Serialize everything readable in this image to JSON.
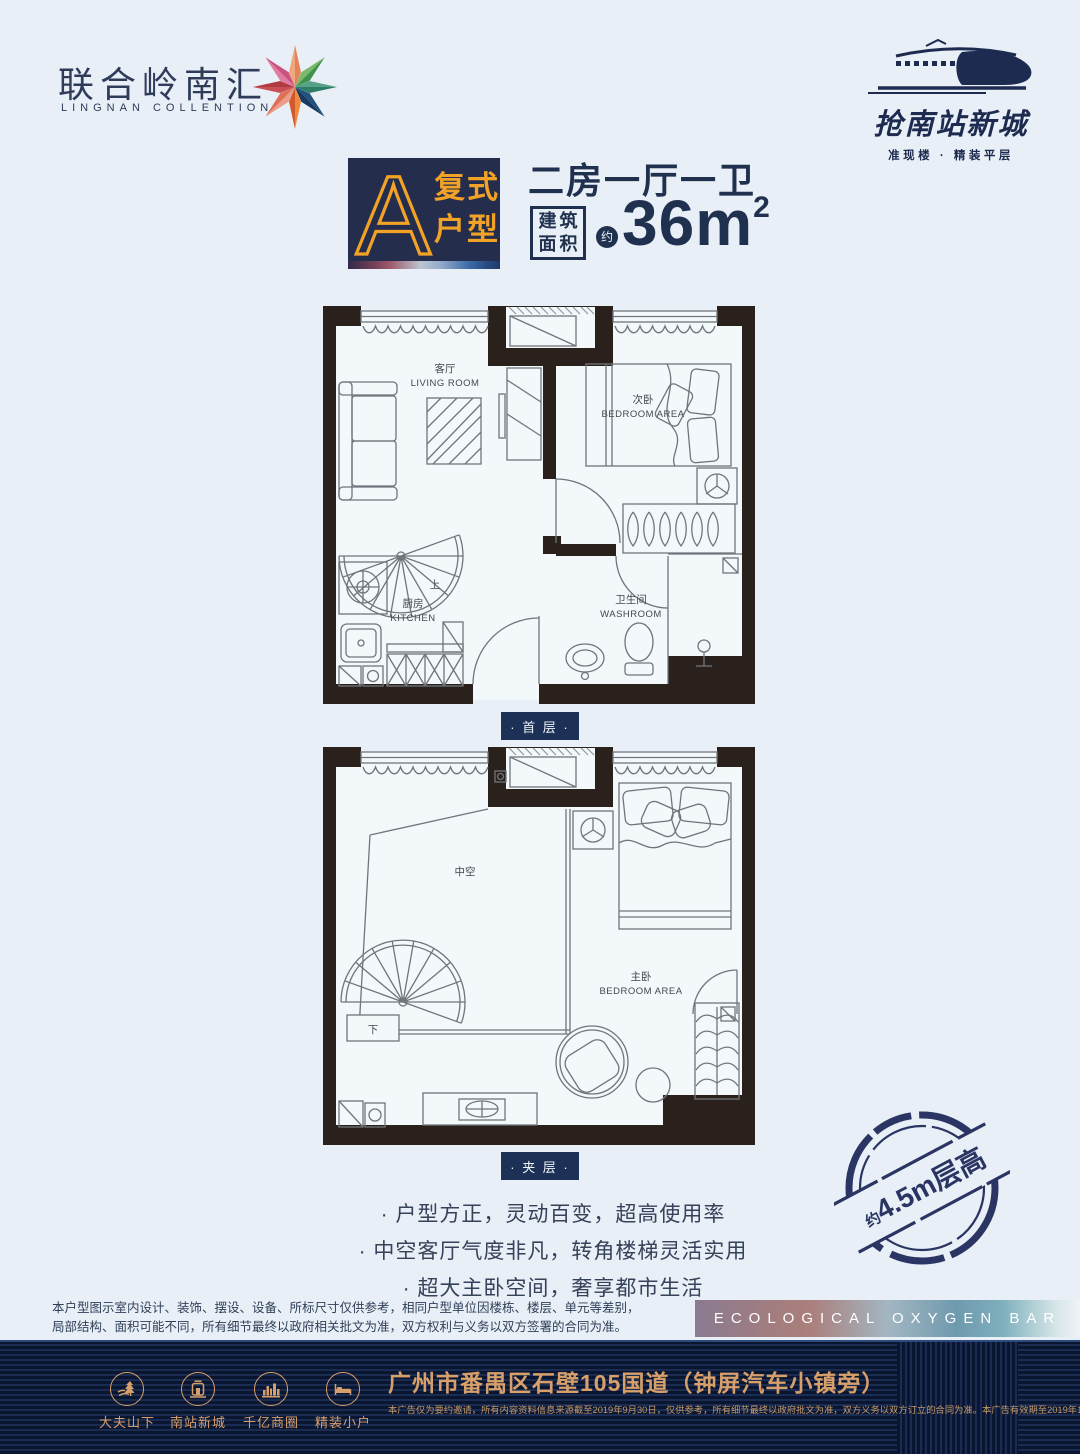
{
  "header": {
    "logo_cn": "联合岭南汇",
    "logo_en": "LINGNAN COLLENTION",
    "campaign": "抢南站新城",
    "campaign_sub": "准现楼 · 精装平层"
  },
  "title": {
    "type_letter": "A",
    "type_line1": "复式",
    "type_line2": "户型",
    "layout": "二房一厅一卫",
    "area_box_line1": "建筑",
    "area_box_line2": "面积",
    "approx": "约",
    "area_value": "36m",
    "area_sup": "2"
  },
  "plan_first": {
    "badge": "· 首 层 ·",
    "living_cn": "客厅",
    "living_en": "LIVING ROOM",
    "bedroom_cn": "次卧",
    "bedroom_en": "BEDROOM AREA",
    "kitchen_cn": "厨房",
    "kitchen_en": "KITCHEN",
    "washroom_cn": "卫生间",
    "washroom_en": "WASHROOM",
    "stair": "上"
  },
  "plan_mezz": {
    "badge": "· 夹 层 ·",
    "void_cn": "中空",
    "bedroom_cn": "主卧",
    "bedroom_en": "BEDROOM AREA",
    "stair": "下"
  },
  "features": [
    "· 户型方正，灵动百变，超高使用率",
    "· 中空客厅气度非凡，转角楼梯灵活实用",
    "· 超大主卧空间，奢享都市生活"
  ],
  "stamp": {
    "prefix": "约",
    "text": "4.5m层高"
  },
  "disclaimer_line1": "本户型图示室内设计、装饰、摆设、设备、所标尺寸仅供参考，相同户型单位因楼栋、楼层、单元等差别，",
  "disclaimer_line2": "局部结构、面积可能不同，所有细节最终以政府相关批文为准，双方权利与义务以双方签署的合同为准。",
  "eco_bar": "ECOLOGICAL OXYGEN BAR",
  "footer": {
    "items": [
      {
        "label": "大夫山下"
      },
      {
        "label": "南站新城"
      },
      {
        "label": "千亿商圈"
      },
      {
        "label": "精装小户"
      }
    ],
    "address": "广州市番禺区石壁105国道（钟屏汽车小镇旁）",
    "legal": "本广告仅为要约邀请，所有内容资料信息来源截至2019年9月30日，仅供参考，所有细节最终以政府批文为准，双方义务以双方订立的合同为准。本广告有效期至2019年12月31日。"
  },
  "colors": {
    "navy": "#20304f",
    "orange": "#f2a227",
    "page_bg": "#e9eff6",
    "wall": "#2a211d",
    "gold": "#d7a06b",
    "footer_bg": "#0a1530",
    "stamp": "#2a3563"
  }
}
